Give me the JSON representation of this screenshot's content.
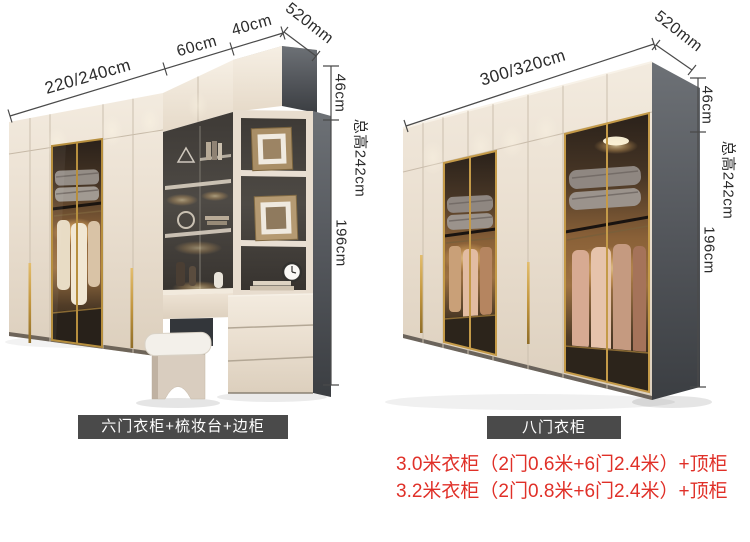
{
  "left_unit": {
    "caption": "六门衣柜+梳妆台+边柜",
    "dimensions": {
      "width": "220/240cm",
      "dresser_width": "60cm",
      "side_cabinet_width": "40cm",
      "depth": "520mm",
      "top_cabinet_height": "46cm",
      "body_height": "196cm",
      "total_height": "总高242cm"
    }
  },
  "right_unit": {
    "caption": "八门衣柜",
    "dimensions": {
      "width": "300/320cm",
      "depth": "520mm",
      "top_cabinet_height": "46cm",
      "body_height": "196cm",
      "total_height": "总高242cm"
    }
  },
  "notes": {
    "line1": "3.0米衣柜（2门0.6米+6门2.4米）+顶柜",
    "line2": "3.2米衣柜（2门0.8米+6门2.4米）+顶柜"
  },
  "colors": {
    "cream_door": "#eadfd0",
    "dark_panel": "#55585d",
    "gold_trim": "#c2963e",
    "badge_background": "#4a4a4a",
    "note_red": "#e03028",
    "dimension_line": "#4a4a4a"
  }
}
